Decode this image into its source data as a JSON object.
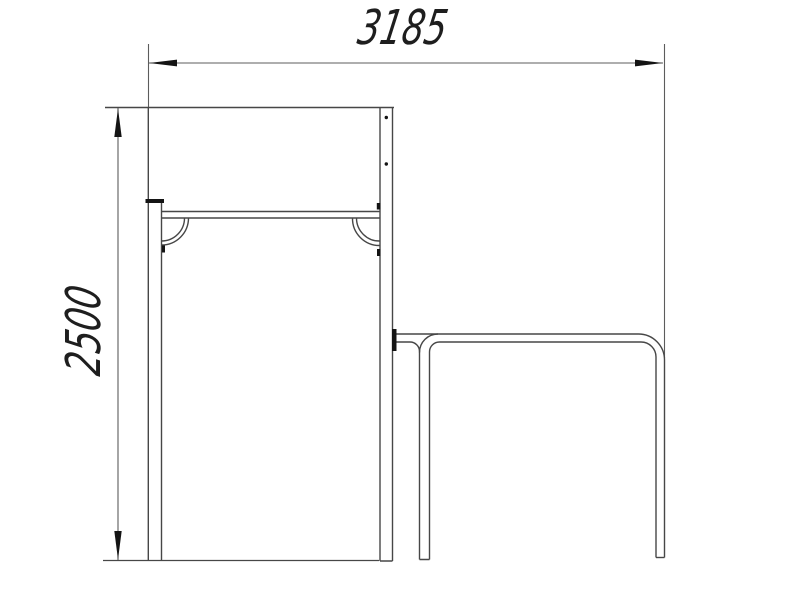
{
  "drawing": {
    "title": "Side-view technical drawing of shelter bench with attached table",
    "dimensions": {
      "width_label": "3185",
      "height_label": "2500"
    },
    "colors": {
      "line": "#474747",
      "dim_line": "#5c5c5c",
      "text": "#1e1e1e",
      "mark": "#141414",
      "background": "#ffffff"
    }
  }
}
